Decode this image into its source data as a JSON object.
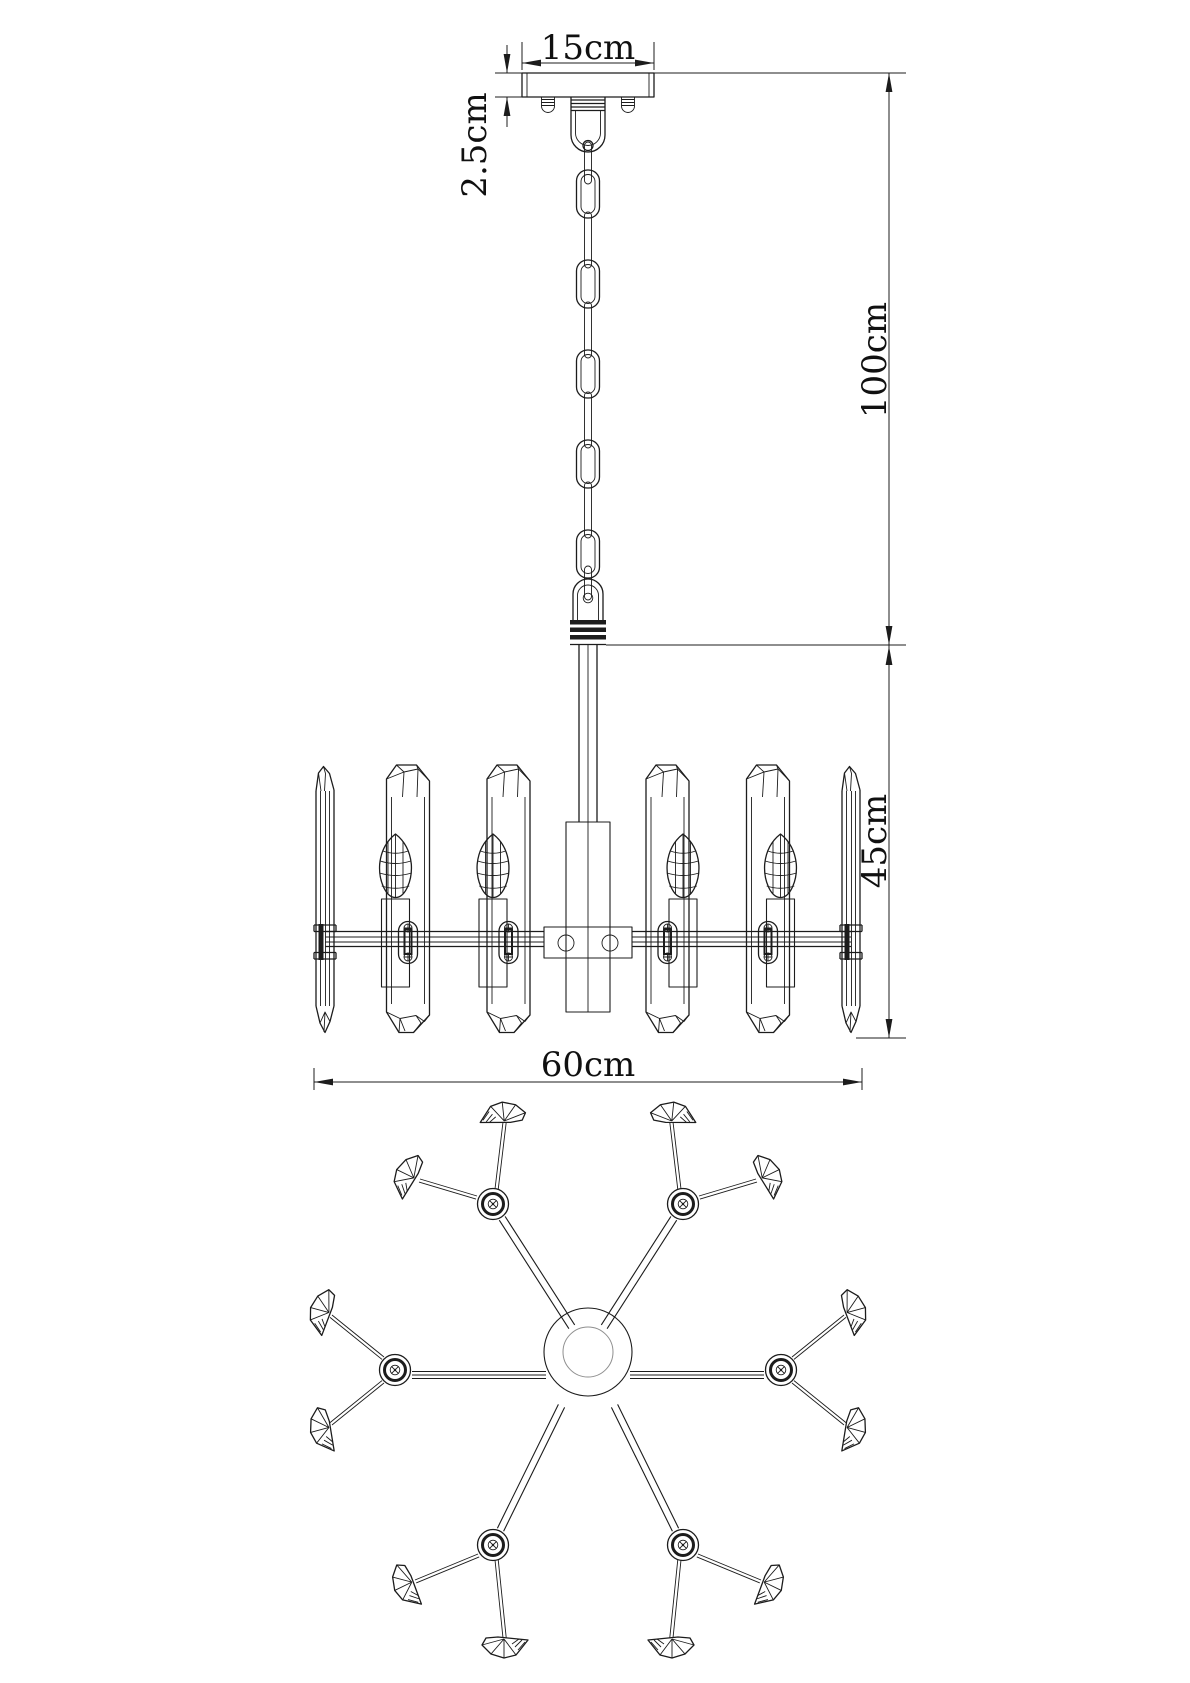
{
  "dimensions": {
    "canopy_width": "15cm",
    "canopy_height": "2.5cm",
    "suspension_height": "100cm",
    "body_height": "45cm",
    "body_width": "60cm"
  },
  "colors": {
    "line": "#1c1c1c",
    "line_light": "#8f8f8f",
    "background": "#ffffff"
  }
}
